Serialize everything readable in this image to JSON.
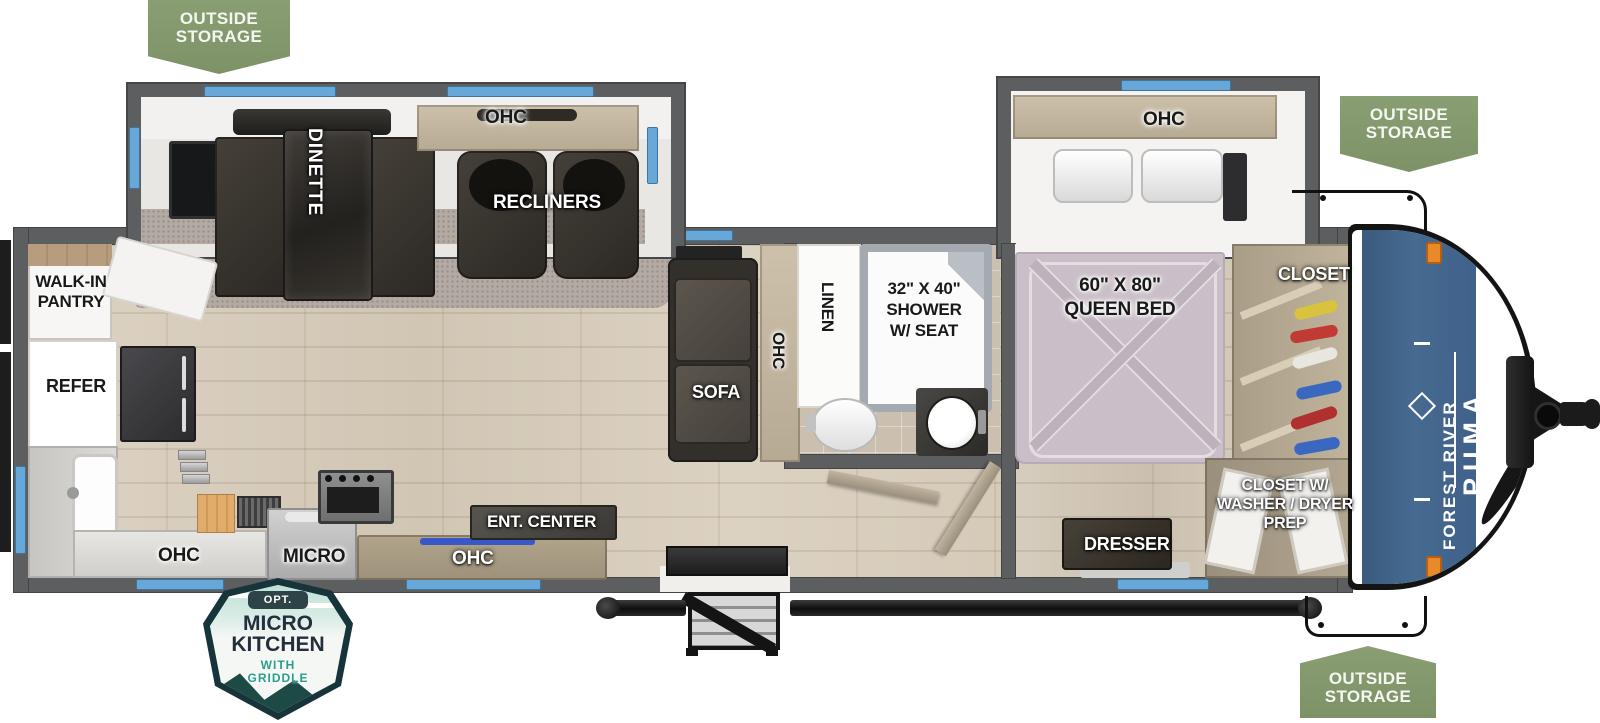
{
  "brand": {
    "manufacturer": "FOREST RIVER",
    "model": "PUMA"
  },
  "badges": {
    "outside_storage": {
      "line1": "OUTSIDE",
      "line2": "STORAGE"
    },
    "micro_kitchen": {
      "opt": "OPT.",
      "title_line1": "MICRO",
      "title_line2": "KITCHEN",
      "sub_line1": "WITH",
      "sub_line2": "GRIDDLE"
    }
  },
  "labels": {
    "dinette": "DINETTE",
    "ohc_dinette": "OHC",
    "recliners": "RECLINERS",
    "walk_in_pantry_line1": "WALK-IN",
    "walk_in_pantry_line2": "PANTRY",
    "refer": "REFER",
    "ohc_kitchen": "OHC",
    "micro": "MICRO",
    "ohc_galley": "OHC",
    "ent_center": "ENT. CENTER",
    "sofa": "SOFA",
    "ohc_sofa": "OHC",
    "linen": "LINEN",
    "shower_line1": "32\" X 40\"",
    "shower_line2": "SHOWER",
    "shower_line3": "W/ SEAT",
    "queen_bed_line1": "60\" X 80\"",
    "queen_bed_line2": "QUEEN BED",
    "ohc_bedroom": "OHC",
    "closet": "CLOSET",
    "dresser": "DRESSER",
    "washer_dryer_line1": "CLOSET W/",
    "washer_dryer_line2": "WASHER / DRYER",
    "washer_dryer_line3": "PREP"
  },
  "colors": {
    "wall_gray": "#5d5e60",
    "window_blue": "#68a8d8",
    "badge_green": "#84996e",
    "cap_blue": "#44658a",
    "floor_wood": "#d9cfc0",
    "carpet_gray": "#b2aaa3",
    "cabinet_tan": "#c2b59e",
    "furniture_dark": "#3a3530",
    "quilt_lavender": "#cabfc8",
    "accent_led_blue": "#3a57c8",
    "badge_teal_dark": "#16343a",
    "badge_teal_text": "#2a9d8f",
    "marker_orange": "#e8892a"
  }
}
